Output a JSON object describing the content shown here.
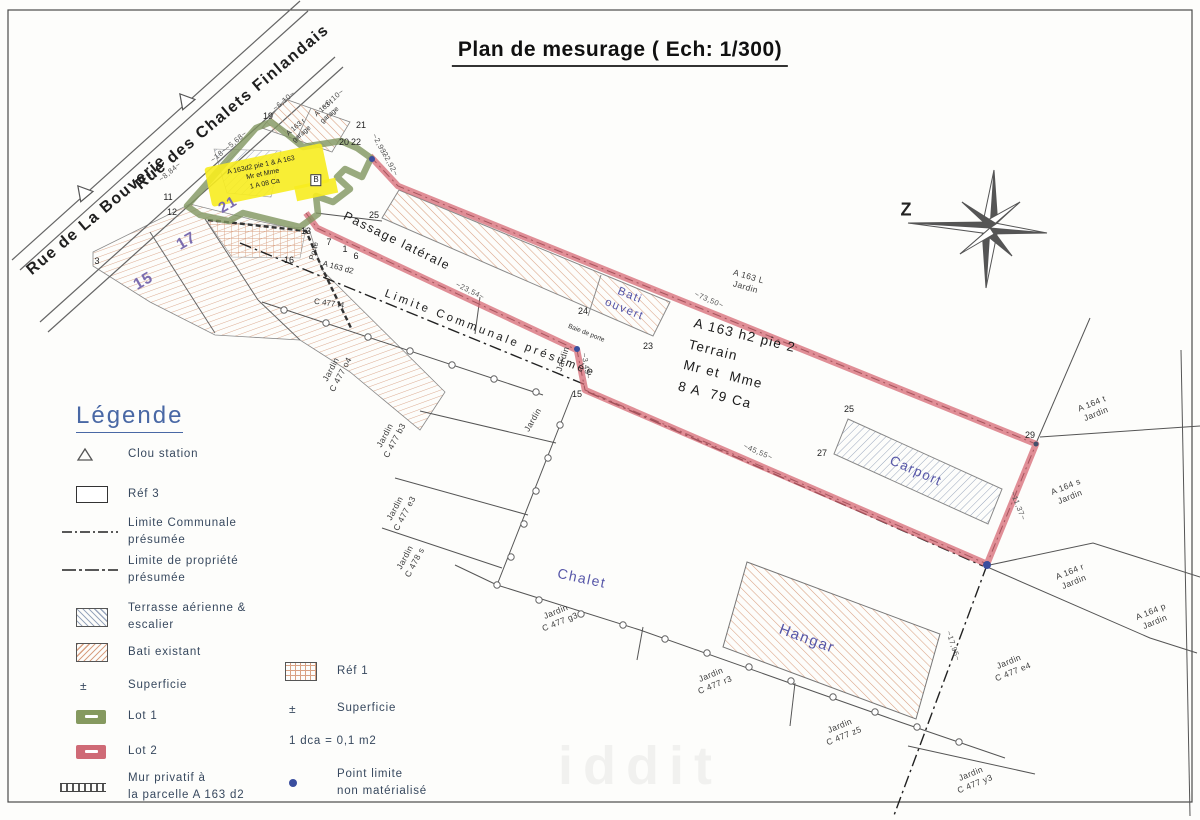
{
  "title": "Plan de mesurage ( Ech: 1/300)",
  "colors": {
    "lot1_green": "#85995f",
    "lot2_red": "#d4626f",
    "bati_hatch_tan": "#d9a183",
    "terrasse_hatch_blue": "#9aa7bd",
    "parcel_number_purple": "#7b6cae",
    "building_label_blue": "#5656a8",
    "legend_heading_blue": "#4968a5",
    "point_limite_blue": "#3a4e9e"
  },
  "legend": {
    "heading": "Légende",
    "pm": "±",
    "col1": [
      {
        "icon": "triangle-icon",
        "label": "Clou station"
      },
      {
        "icon": "rect-icon",
        "label": "Réf 3"
      },
      {
        "icon": "dashdot-line-icon",
        "label": "Limite Communale\nprésumée"
      },
      {
        "icon": "dashdot-line-icon",
        "label": "Limite de propriété\nprésumée"
      },
      {
        "icon": "hatch-blue-swatch",
        "label": "Terrasse aérienne &\nescalier"
      },
      {
        "icon": "hatch-tan-swatch",
        "label": "Bati existant"
      },
      {
        "icon": "plus-minus-icon",
        "label": "Superficie"
      },
      {
        "icon": "lot1-swatch",
        "label": "Lot 1"
      },
      {
        "icon": "lot2-swatch",
        "label": "Lot 2"
      },
      {
        "icon": "mur-line-icon",
        "label": "Mur privatif à\nla parcelle A 163 d2"
      }
    ],
    "col2": [
      {
        "icon": "hatch-grid-swatch",
        "label": "Réf 1"
      },
      {
        "icon": "plus-minus-icon",
        "label": "Superficie"
      },
      {
        "icon": "none",
        "label": "1 dca = 0,1 m2"
      },
      {
        "icon": "blue-dot-icon",
        "label": "Point limite\nnon matérialisé"
      }
    ]
  },
  "map": {
    "labels": [
      {
        "id": "street-rue-de-la-bouverie",
        "text": "Rue de La Bouverie",
        "x": 97,
        "y": 216,
        "rot": -40,
        "cls": "street"
      },
      {
        "id": "street-rue-des-chalets-finlandais",
        "text": "Rue des Chalets Finlandais",
        "x": 233,
        "y": 108,
        "rot": -40,
        "cls": "street"
      },
      {
        "id": "compass-label",
        "text": "Z",
        "x": 906,
        "y": 210,
        "rot": 0,
        "cls": "z"
      },
      {
        "id": "building-chalet",
        "text": "Chalet",
        "x": 582,
        "y": 578,
        "rot": 12,
        "cls": "blue",
        "size": 14
      },
      {
        "id": "building-hangar",
        "text": "Hangar",
        "x": 807,
        "y": 639,
        "rot": 20,
        "cls": "blue",
        "size": 15
      },
      {
        "id": "building-carport",
        "text": "Carport",
        "x": 916,
        "y": 471,
        "rot": 24,
        "cls": "blue",
        "size": 13.5
      },
      {
        "id": "building-bati-ouvert",
        "text": "Bati\nouvert",
        "x": 627,
        "y": 303,
        "rot": 22,
        "cls": "blue",
        "size": 11.5
      },
      {
        "id": "parcel-terrain-block",
        "text": "A 163 h2 pie 2\nTerrain\nMr et  Mme\n8 A  79 Ca",
        "x": 737,
        "y": 367,
        "rot": 14,
        "cls": "terrain"
      },
      {
        "id": "limite-communale-text",
        "text": "Limite Communale présumée",
        "x": 490,
        "y": 334,
        "rot": 21,
        "cls": "limite"
      },
      {
        "id": "passage-laterale-text",
        "text": "Passage latérale",
        "x": 397,
        "y": 241,
        "rot": 26,
        "cls": "passage"
      },
      {
        "id": "parcel-a163l",
        "text": "A 163 L\nJardin",
        "x": 747,
        "y": 282,
        "rot": 16,
        "cls": "jardin"
      },
      {
        "id": "parcel-a164t",
        "text": "A 164 t\nJardin",
        "x": 1094,
        "y": 409,
        "rot": -22,
        "cls": "jardin"
      },
      {
        "id": "parcel-a164s",
        "text": "A 164 s\nJardin",
        "x": 1068,
        "y": 492,
        "rot": -22,
        "cls": "jardin"
      },
      {
        "id": "parcel-a164r",
        "text": "A 164 r\nJardin",
        "x": 1072,
        "y": 577,
        "rot": -22,
        "cls": "jardin"
      },
      {
        "id": "parcel-a164p",
        "text": "A 164 p\nJardin",
        "x": 1153,
        "y": 617,
        "rot": -22,
        "cls": "jardin"
      },
      {
        "id": "parcel-c477e4",
        "text": "Jardin\nC 477 e4",
        "x": 1011,
        "y": 667,
        "rot": -22,
        "cls": "jardin"
      },
      {
        "id": "parcel-c477y3",
        "text": "Jardin\nC 477 y3",
        "x": 973,
        "y": 779,
        "rot": -22,
        "cls": "jardin"
      },
      {
        "id": "parcel-c477z5",
        "text": "Jardin\nC 477 z5",
        "x": 842,
        "y": 731,
        "rot": -22,
        "cls": "jardin"
      },
      {
        "id": "parcel-c477r3",
        "text": "Jardin\nC 477 r3",
        "x": 713,
        "y": 680,
        "rot": -22,
        "cls": "jardin"
      },
      {
        "id": "parcel-c477g3",
        "text": "Jardin\nC 477 g3",
        "x": 558,
        "y": 617,
        "rot": -22,
        "cls": "jardin"
      },
      {
        "id": "parcel-c478s",
        "text": "Jardin\nC 478 s",
        "x": 410,
        "y": 560,
        "rot": -62,
        "cls": "jardin"
      },
      {
        "id": "parcel-c477e3",
        "text": "Jardin\nC 477 e3",
        "x": 400,
        "y": 511,
        "rot": -62,
        "cls": "jardin"
      },
      {
        "id": "parcel-c477b3",
        "text": "Jardin\nC 477 b3",
        "x": 390,
        "y": 438,
        "rot": -62,
        "cls": "jardin"
      },
      {
        "id": "parcel-c477o4",
        "text": "Jardin\nC 477 o4",
        "x": 336,
        "y": 372,
        "rot": -62,
        "cls": "jardin"
      },
      {
        "id": "parcel-jardin-1",
        "text": "Jardin",
        "x": 563,
        "y": 359,
        "rot": -72,
        "cls": "jardin"
      },
      {
        "id": "parcel-jardin-2",
        "text": "Jardin",
        "x": 533,
        "y": 420,
        "rot": -60,
        "cls": "jardin"
      },
      {
        "id": "note-porte",
        "text": "Porte",
        "x": 314,
        "y": 251,
        "rot": -75,
        "cls": "tiny"
      },
      {
        "id": "parcel-a163d2",
        "text": "A 163 d2",
        "x": 338,
        "y": 268,
        "rot": 15,
        "cls": "tiny",
        "size": 8
      },
      {
        "id": "parcel-c477t4",
        "text": "C 477 t4",
        "x": 329,
        "y": 304,
        "rot": 8,
        "cls": "tiny",
        "size": 8
      },
      {
        "id": "note-baie-de-porte",
        "text": "Baie de porte",
        "x": 586,
        "y": 334,
        "rot": 22,
        "cls": "tiny",
        "size": 6.5
      },
      {
        "id": "parcel-a163r-garage",
        "text": "A 163 r\ngarage",
        "x": 299,
        "y": 131,
        "rot": -40,
        "cls": "tiny",
        "size": 7
      },
      {
        "id": "parcel-a163f-garage",
        "text": "A 163 f\ngarage",
        "x": 327,
        "y": 112,
        "rot": -40,
        "cls": "tiny",
        "size": 7
      },
      {
        "id": "highlight-note",
        "text": "A 163d2 pie 1 & A 163\nMr et  Mme\n1 A 08 Ca",
        "x": 263,
        "y": 175,
        "rot": -12,
        "cls": "ynote"
      },
      {
        "id": "meas-8-84",
        "text": "~8,84~",
        "x": 170,
        "y": 172,
        "rot": -40,
        "cls": "meas"
      },
      {
        "id": "meas-18",
        "text": "~18~",
        "x": 219,
        "y": 155,
        "rot": -40,
        "cls": "meas"
      },
      {
        "id": "meas-5-68",
        "text": "~5,68~",
        "x": 236,
        "y": 141,
        "rot": -40,
        "cls": "meas"
      },
      {
        "id": "meas-6-10-a",
        "text": "~6,10~",
        "x": 284,
        "y": 101,
        "rot": -40,
        "cls": "meas"
      },
      {
        "id": "meas-6-10-b",
        "text": "~6,10~",
        "x": 333,
        "y": 99,
        "rot": -40,
        "cls": "meas"
      },
      {
        "id": "meas-2-93",
        "text": "~2,93~",
        "x": 380,
        "y": 146,
        "rot": 62,
        "cls": "meas"
      },
      {
        "id": "meas-22-92",
        "text": "~22,92~",
        "x": 389,
        "y": 162,
        "rot": 62,
        "cls": "meas"
      },
      {
        "id": "meas-23-54",
        "text": "~23,54~",
        "x": 470,
        "y": 291,
        "rot": 26,
        "cls": "meas"
      },
      {
        "id": "meas-73-50",
        "text": "~73,50~",
        "x": 709,
        "y": 300,
        "rot": 23,
        "cls": "meas"
      },
      {
        "id": "meas-45-55",
        "text": "~45,55~",
        "x": 758,
        "y": 452,
        "rot": 23,
        "cls": "meas"
      },
      {
        "id": "meas-3-43",
        "text": "~3,43~",
        "x": 586,
        "y": 366,
        "rot": 80,
        "cls": "meas"
      },
      {
        "id": "meas-11-37",
        "text": "~11,37~",
        "x": 1018,
        "y": 506,
        "rot": 68,
        "cls": "meas"
      },
      {
        "id": "meas-17-95",
        "text": "~17,95~",
        "x": 953,
        "y": 646,
        "rot": 72,
        "cls": "meas"
      },
      {
        "id": "point-19",
        "text": "19",
        "x": 268,
        "y": 117,
        "rot": 0,
        "cls": "num"
      },
      {
        "id": "point-21",
        "text": "21",
        "x": 361,
        "y": 126,
        "rot": 0,
        "cls": "num"
      },
      {
        "id": "point-20",
        "text": "20",
        "x": 344,
        "y": 143,
        "rot": 0,
        "cls": "num"
      },
      {
        "id": "point-22",
        "text": "22",
        "x": 356,
        "y": 143,
        "rot": 0,
        "cls": "num"
      },
      {
        "id": "point-25",
        "text": "25",
        "x": 374,
        "y": 216,
        "rot": 0,
        "cls": "num"
      },
      {
        "id": "point-7",
        "text": "7",
        "x": 329,
        "y": 243,
        "rot": 0,
        "cls": "num"
      },
      {
        "id": "point-1",
        "text": "1",
        "x": 345,
        "y": 250,
        "rot": 0,
        "cls": "num"
      },
      {
        "id": "point-6",
        "text": "6",
        "x": 356,
        "y": 257,
        "rot": 0,
        "cls": "num"
      },
      {
        "id": "point-13",
        "text": "13",
        "x": 306,
        "y": 232,
        "rot": 0,
        "cls": "num"
      },
      {
        "id": "point-3",
        "text": "3",
        "x": 97,
        "y": 262,
        "rot": 0,
        "cls": "num"
      },
      {
        "id": "point-11",
        "text": "11",
        "x": 168,
        "y": 198,
        "rot": 0,
        "cls": "num"
      },
      {
        "id": "point-12",
        "text": "12",
        "x": 172,
        "y": 213,
        "rot": 0,
        "cls": "num"
      },
      {
        "id": "point-16",
        "text": "16",
        "x": 289,
        "y": 261,
        "rot": 0,
        "cls": "num"
      },
      {
        "id": "point-24",
        "text": "24",
        "x": 583,
        "y": 312,
        "rot": 0,
        "cls": "num"
      },
      {
        "id": "point-23",
        "text": "23",
        "x": 648,
        "y": 347,
        "rot": 0,
        "cls": "num"
      },
      {
        "id": "point-15",
        "text": "15",
        "x": 577,
        "y": 395,
        "rot": 0,
        "cls": "num"
      },
      {
        "id": "point-25b",
        "text": "25",
        "x": 849,
        "y": 410,
        "rot": 0,
        "cls": "num"
      },
      {
        "id": "point-27",
        "text": "27",
        "x": 822,
        "y": 454,
        "rot": 0,
        "cls": "num"
      },
      {
        "id": "point-29",
        "text": "29",
        "x": 1030,
        "y": 436,
        "rot": 0,
        "cls": "num"
      },
      {
        "id": "parcel-number-21",
        "text": "21",
        "x": 228,
        "y": 205,
        "rot": -30,
        "cls": "numpurple"
      },
      {
        "id": "parcel-number-17",
        "text": "17",
        "x": 187,
        "y": 242,
        "rot": -30,
        "cls": "numpurple",
        "size": 16
      },
      {
        "id": "parcel-number-15",
        "text": "15",
        "x": 144,
        "y": 282,
        "rot": -30,
        "cls": "numpurple",
        "size": 16
      },
      {
        "id": "station-b",
        "text": "B",
        "x": 316,
        "y": 180,
        "rot": 0,
        "cls": "pointbox"
      },
      {
        "id": "watermark",
        "text": "iddit",
        "x": 640,
        "y": 766,
        "rot": 0,
        "cls": "watermark"
      }
    ]
  }
}
